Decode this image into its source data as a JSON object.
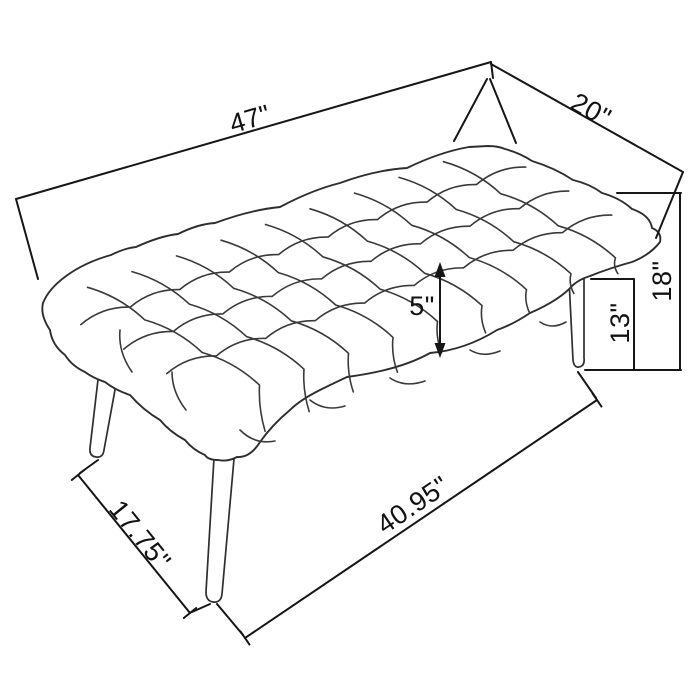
{
  "diagram": {
    "alt": "Black-and-white dimension line drawing of a diamond-tufted upholstered bench on four splayed tapered legs",
    "labels": {
      "length": "47\"",
      "depth": "20\"",
      "overall_height": "18\"",
      "leg_height": "13\"",
      "cushion_thickness": "5\"",
      "leg_span_depth": "17.75\"",
      "leg_span_length": "40.95\""
    },
    "colors": {
      "line": "#3a3a3a",
      "dimension": "#161616",
      "background": "#ffffff"
    }
  }
}
